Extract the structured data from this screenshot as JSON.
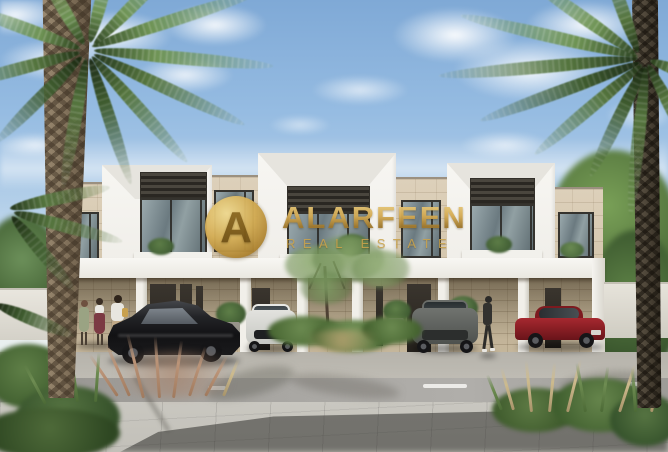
{
  "watermark": {
    "monogram": "A",
    "brand": "ALARFEEN",
    "tagline": "REAL ESTATE",
    "gold_color": "#c9a24b"
  },
  "palette": {
    "sky_top": "#7fa9d6",
    "sky_horizon": "#e4edf3",
    "facade_white": "#f4f3ef",
    "facade_stone": "#d8cbb4",
    "canopy_white": "#f8f7f3",
    "pavement": "#c6c4bd",
    "asphalt": "#a3a19d",
    "palm_green": "#6f9455",
    "black_car": "#1b1b1d",
    "white_suv": "#dcdcd8",
    "gray_suv": "#5f625f",
    "red_car": "#8e2026"
  }
}
